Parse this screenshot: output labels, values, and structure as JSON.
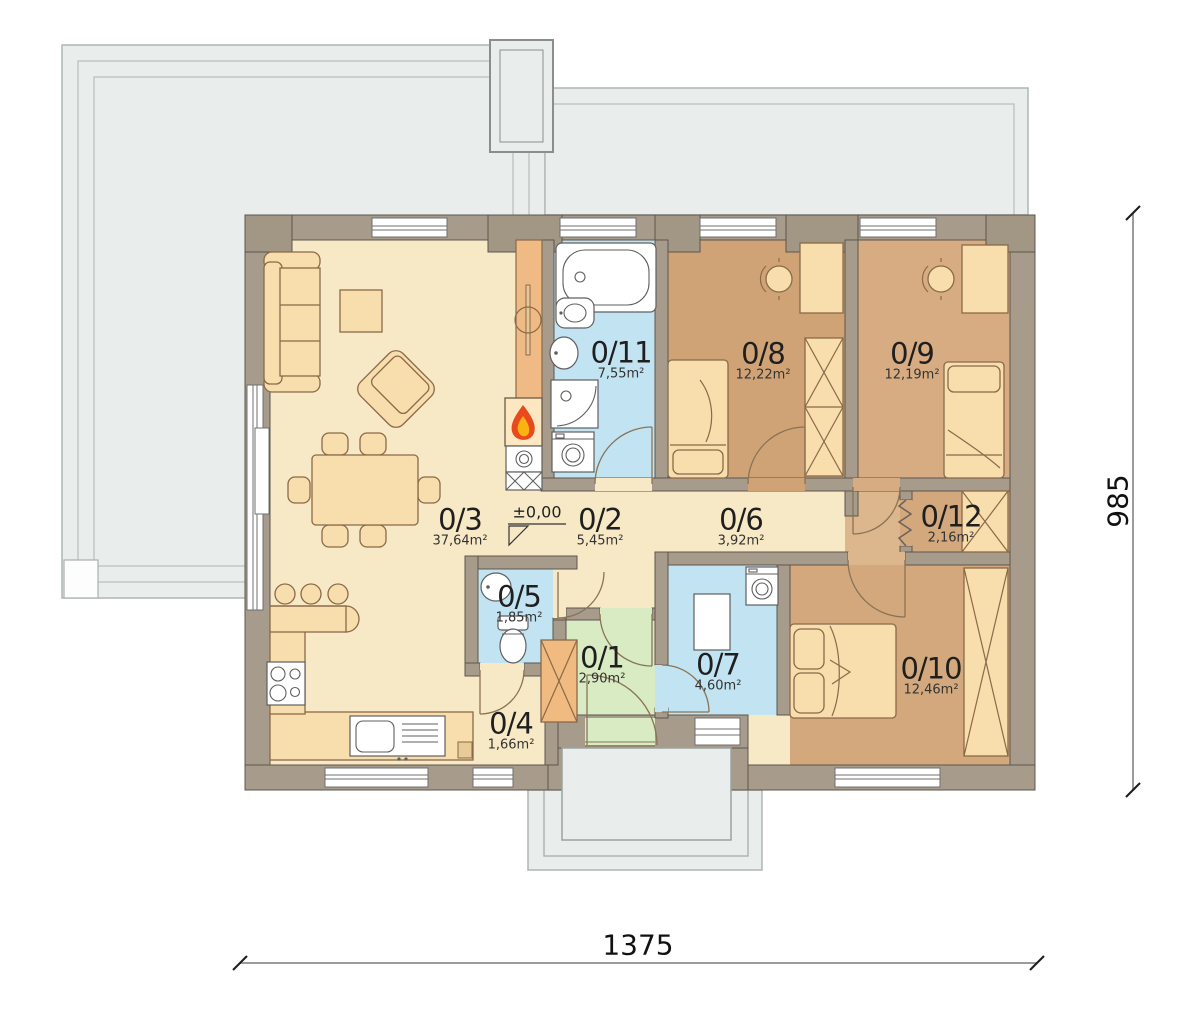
{
  "plan": {
    "rooms": [
      {
        "number": "0/1",
        "area": "2,90m²"
      },
      {
        "number": "0/2",
        "area": "5,45m²"
      },
      {
        "number": "0/3",
        "area": "37,64m²"
      },
      {
        "number": "0/4",
        "area": "1,66m²"
      },
      {
        "number": "0/5",
        "area": "1,85m²"
      },
      {
        "number": "0/6",
        "area": "3,92m²"
      },
      {
        "number": "0/7",
        "area": "4,60m²"
      },
      {
        "number": "0/8",
        "area": "12,22m²"
      },
      {
        "number": "0/9",
        "area": "12,19m²"
      },
      {
        "number": "0/10",
        "area": "12,46m²"
      },
      {
        "number": "0/11",
        "area": "7,55m²"
      },
      {
        "number": "0/12",
        "area": "2,16m²"
      }
    ],
    "elevation_label": "±0,00",
    "dimensions": {
      "width_cm": "1375",
      "height_cm": "985"
    },
    "colors": {
      "living_floor": "#f7e9c6",
      "bath_floor": "#c2e4f2",
      "bedroom_floor": "#d2a77b",
      "entry_floor": "#d9ebc3",
      "wall": "#a79b8b",
      "terrace": "#e9edec",
      "furniture": "#f8ddad",
      "flame_red": "#e8491d",
      "flame_yellow": "#f9b411"
    }
  }
}
